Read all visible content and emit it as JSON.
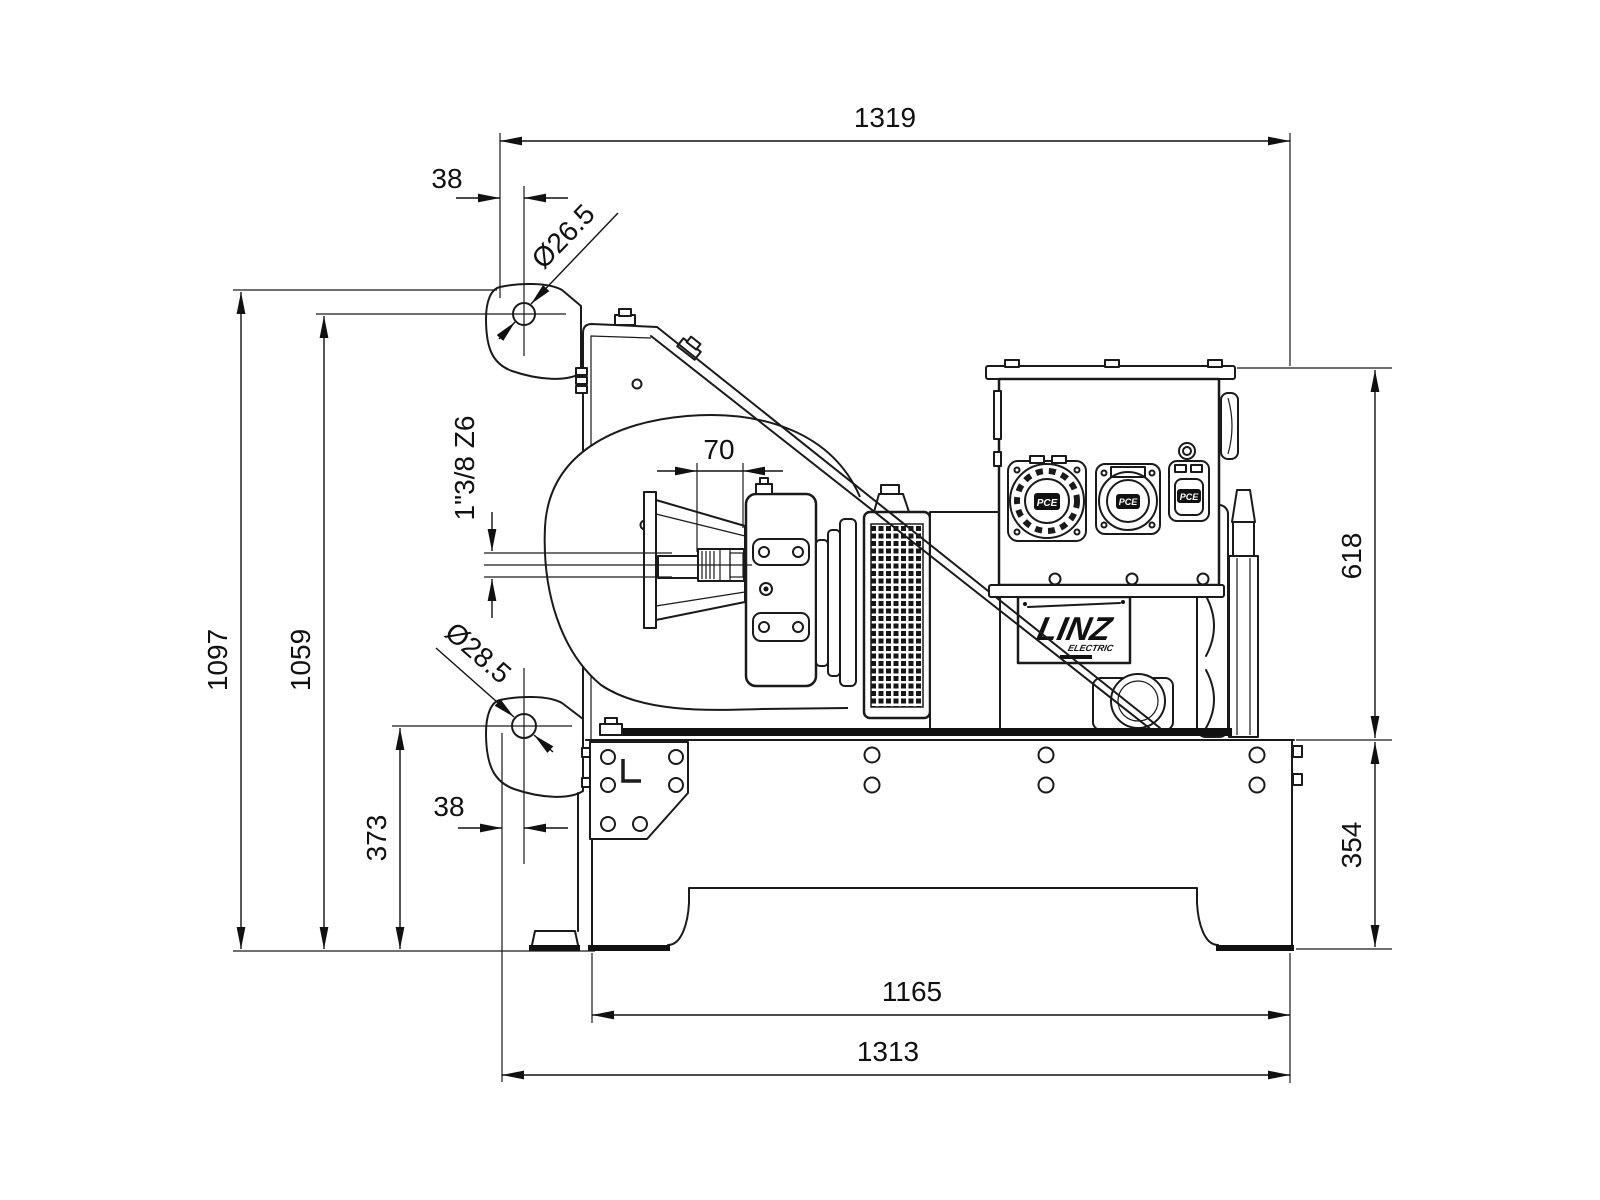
{
  "page": {
    "background": "#ffffff",
    "line_color": "#1a1a1a",
    "thick_color": "#111111"
  },
  "drawing": {
    "type": "technical-dimension-drawing",
    "view": "side-elevation",
    "brand": {
      "name": "LINZ",
      "sub": "ELECTRIC"
    },
    "panel": {
      "socket_label": "PCE"
    },
    "frame": {
      "bracket_mark": "L"
    },
    "dimensions": {
      "overall_length_top": "1319",
      "top_hole_offset": "38",
      "top_hole_diameter": "Ø26.5",
      "shaft_engagement": "70",
      "pto_shaft_spec": "1\"3/8 Z6",
      "overall_height": "1097",
      "top_hole_height": "1059",
      "bottom_hole_diameter": "Ø28.5",
      "bottom_hole_height": "373",
      "bottom_hole_offset": "38",
      "alternator_height": "618",
      "frame_height": "354",
      "skid_length": "1165",
      "overall_base_length": "1313"
    }
  }
}
